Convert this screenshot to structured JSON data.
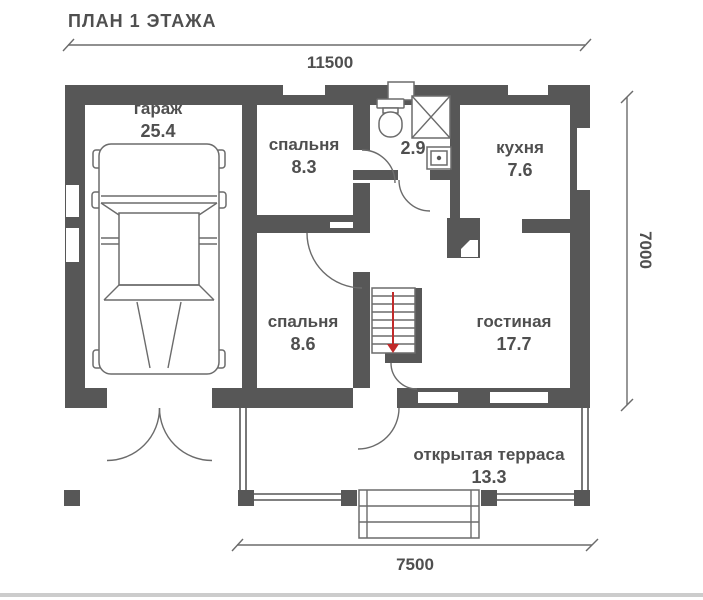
{
  "title": "ПЛАН 1 ЭТАЖА",
  "colors": {
    "wall": "#575757",
    "text": "#4f4f4f",
    "furniture_line": "#6b6b6b",
    "stair_arrow": "#c02a2a",
    "footer_bar": "#cccccc"
  },
  "rooms": {
    "garage": {
      "name": "гараж",
      "area": "25.4"
    },
    "bedroom1": {
      "name": "спальня",
      "area": "8.3"
    },
    "bathroom": {
      "area": "2.9"
    },
    "kitchen": {
      "name": "кухня",
      "area": "7.6"
    },
    "bedroom2": {
      "name": "спальня",
      "area": "8.6"
    },
    "living": {
      "name": "гостиная",
      "area": "17.7"
    },
    "terrace": {
      "name": "открытая терраса",
      "area": "13.3"
    }
  },
  "dimensions": {
    "width_total": "11500",
    "depth_total": "7000",
    "terrace_width": "7500"
  }
}
